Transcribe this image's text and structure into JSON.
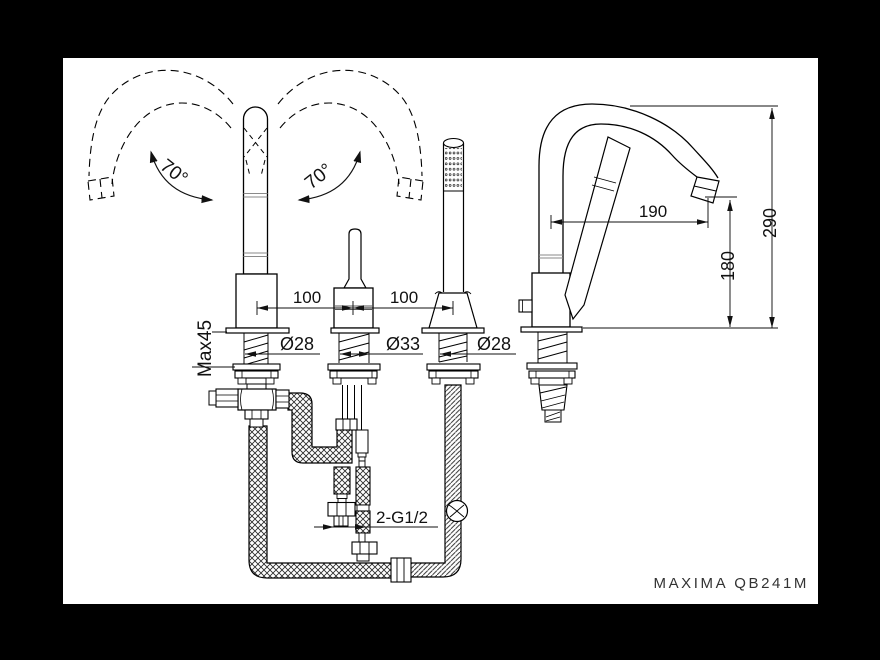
{
  "frame": {
    "border_color": "#000000",
    "canvas_color": "#ffffff"
  },
  "title": {
    "model_label": "MAXIMA QB241M"
  },
  "annotations": {
    "swivel_left": "70°",
    "swivel_right": "70°",
    "spacing_left": "100",
    "spacing_right": "100",
    "max_deck_thickness": "Max45",
    "dia_spout": "Ø28",
    "dia_mixer": "Ø33",
    "dia_shower": "Ø28",
    "supply_connection": "2-G1/2",
    "spout_reach": "190",
    "spout_height": "180",
    "total_height": "290"
  }
}
